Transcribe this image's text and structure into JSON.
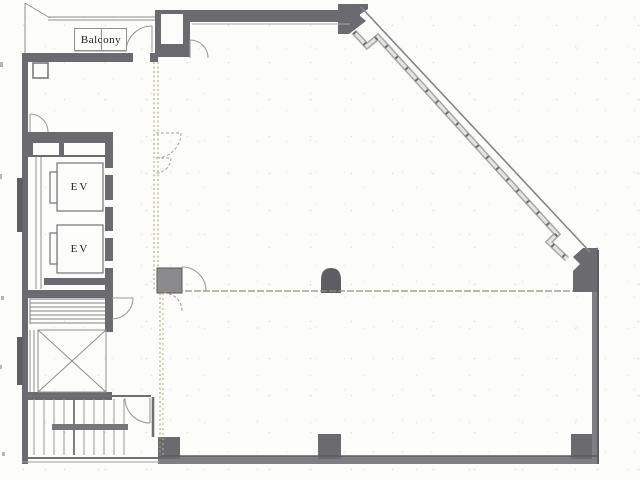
{
  "plan": {
    "balcony": {
      "label": "Balcony"
    },
    "elevators": [
      {
        "label": "EV"
      },
      {
        "label": "EV"
      }
    ],
    "rooms": {
      "stairwell": "stairs",
      "elevator_hall": "elevator-bank",
      "void_shaft": "x-void"
    },
    "colors": {
      "wall": "#6b6b6f",
      "wall_dark": "#5e5e62",
      "wall_light": "#7f7f83",
      "line": "#8f8f8f",
      "door_arc": "#9c9c9c",
      "partition_dash": "#9a937f",
      "paper": "#fcfcfa",
      "text": "#1d1d1d"
    }
  }
}
